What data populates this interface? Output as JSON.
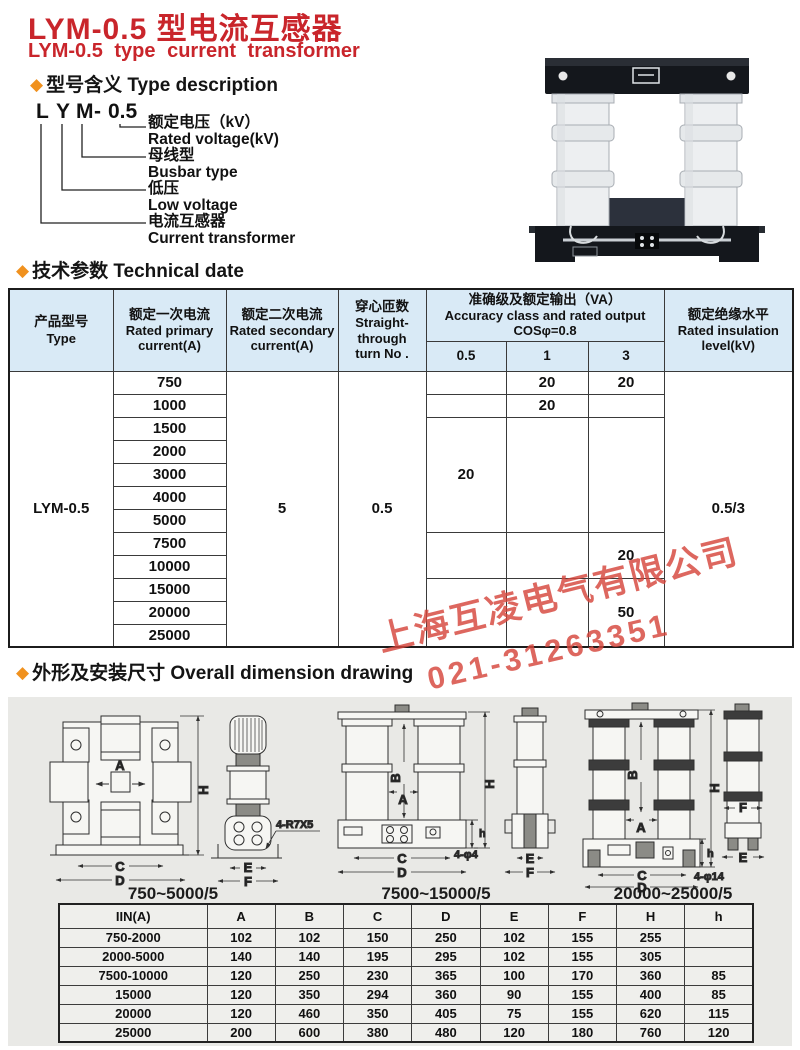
{
  "icons": {
    "diamond": "◆"
  },
  "header": {
    "title_zh": "LYM-0.5 型电流互感器",
    "title_en": "LYM-0.5 type current transformer"
  },
  "sections": {
    "type_desc": "型号含义 Type description",
    "tech": "技术参数 Technical date",
    "dims": "外形及安装尺寸 Overall dimension drawing"
  },
  "model_diagram": {
    "chars": [
      "L",
      "Y",
      "M",
      "-",
      "0.5"
    ],
    "items": [
      {
        "zh": "额定电压（kV）",
        "en": "Rated voltage(kV)"
      },
      {
        "zh": "母线型",
        "en": "Busbar type"
      },
      {
        "zh": "低压",
        "en": "Low voltage"
      },
      {
        "zh": "电流互感器",
        "en": "Current transformer"
      }
    ]
  },
  "tech_table": {
    "headers": {
      "type_zh": "产品型号",
      "type_en": "Type",
      "primary_zh": "额定一次电流",
      "primary_en": "Rated primary current(A)",
      "secondary_zh": "额定二次电流",
      "secondary_en": "Rated secondary current(A)",
      "turns_zh": "穿心匝数",
      "turns_en1": "Straight-",
      "turns_en2": "through",
      "turns_en3": "turn No .",
      "accuracy_zh": "准确级及额定输出（VA）",
      "accuracy_en": "Accuracy class and rated output",
      "accuracy_cos": "COSφ=0.8",
      "acc_cols": [
        "0.5",
        "1",
        "3"
      ],
      "insulation_zh": "额定绝缘水平",
      "insulation_en": "Rated insulation level(kV)"
    },
    "type_value": "LYM-0.5",
    "secondary_value": "5",
    "turns_value": "0.5",
    "insulation_value": "0.5/3",
    "primary_values": [
      "750",
      "1000",
      "1500",
      "2000",
      "3000",
      "4000",
      "5000",
      "7500",
      "10000",
      "15000",
      "20000",
      "25000"
    ],
    "acc_cells": {
      "row750_c1": "20",
      "row750_c3": "20",
      "row1000_c1": "20",
      "mid_c05": "20",
      "high_c3": "20",
      "top_c3": "50"
    }
  },
  "watermark": {
    "company": "上海互凌电气有限公司",
    "phone": "021-31263351"
  },
  "drawings": {
    "captions": [
      "750~5000/5",
      "7500~15000/5",
      "20000~25000/5"
    ],
    "notes": [
      "4-R7X5",
      "4-φ4",
      "4-φ14"
    ],
    "g1_labels": {
      "A": "A",
      "H": "H",
      "C": "C",
      "D": "D",
      "E": "E",
      "F": "F"
    },
    "g2_labels": {
      "A": "A",
      "B": "B",
      "H": "H",
      "h": "h",
      "C": "C",
      "D": "D",
      "E": "E",
      "F": "F"
    },
    "g3_labels": {
      "A": "A",
      "B": "B",
      "H": "H",
      "h": "h",
      "C": "C",
      "D": "D",
      "E": "E",
      "F": "F"
    }
  },
  "dim_table": {
    "headers": [
      "IIN(A)",
      "A",
      "B",
      "C",
      "D",
      "E",
      "F",
      "H",
      "h"
    ],
    "rows": [
      [
        "750-2000",
        "102",
        "102",
        "150",
        "250",
        "102",
        "155",
        "255",
        ""
      ],
      [
        "2000-5000",
        "140",
        "140",
        "195",
        "295",
        "102",
        "155",
        "305",
        ""
      ],
      [
        "7500-10000",
        "120",
        "250",
        "230",
        "365",
        "100",
        "170",
        "360",
        "85"
      ],
      [
        "15000",
        "120",
        "350",
        "294",
        "360",
        "90",
        "155",
        "400",
        "85"
      ],
      [
        "20000",
        "120",
        "460",
        "350",
        "405",
        "75",
        "155",
        "620",
        "115"
      ],
      [
        "25000",
        "200",
        "600",
        "380",
        "480",
        "120",
        "180",
        "760",
        "120"
      ]
    ]
  }
}
